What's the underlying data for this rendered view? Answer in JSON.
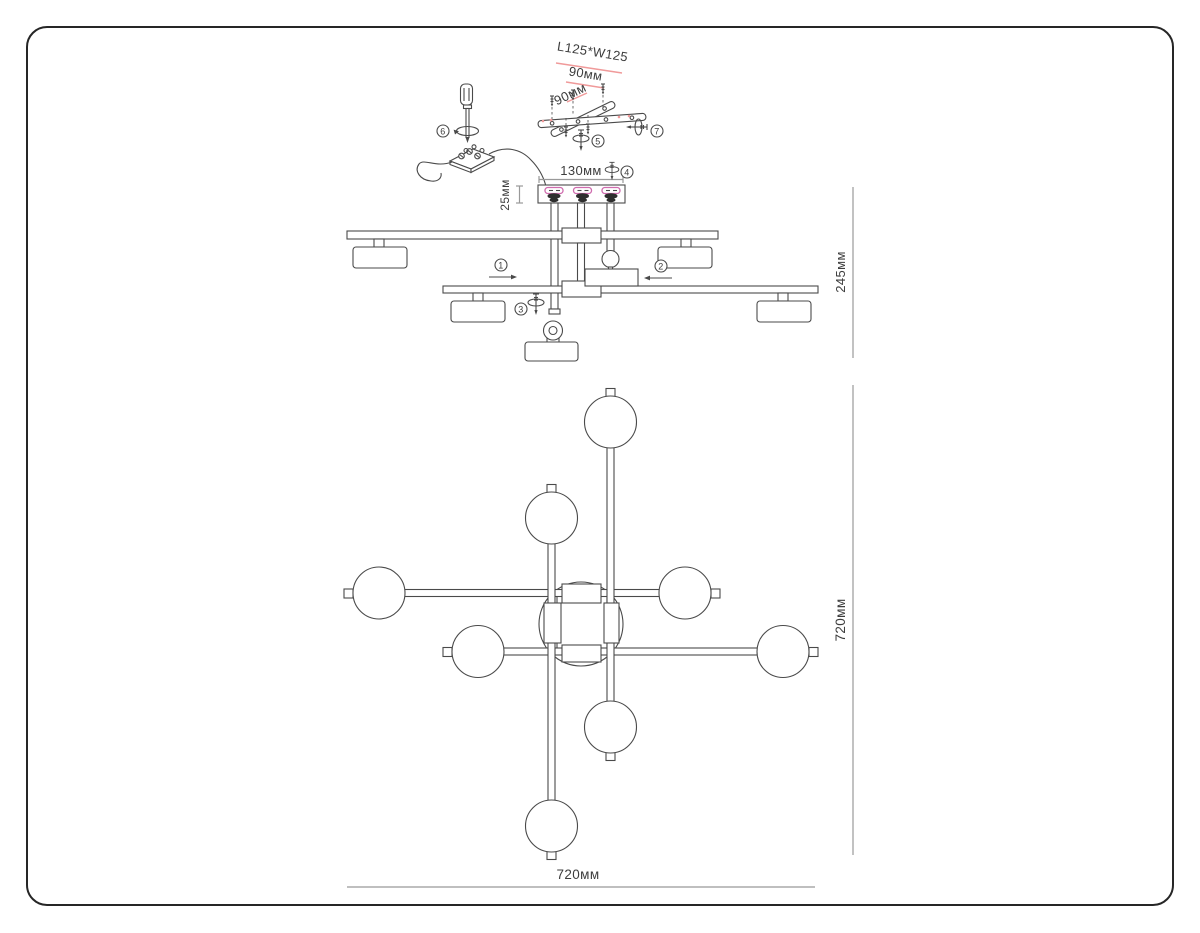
{
  "title": "Ceiling chandelier assembly instruction drawing",
  "colors": {
    "line": "#4a4a4a",
    "dim-line": "#999999",
    "text": "#3d3d3d",
    "accent-red": "#f09a9a",
    "accent-pink": "#cf6cae",
    "dark-fill": "#2e2e2e",
    "frame": "#262626",
    "background": "#ffffff"
  },
  "dimensions": {
    "bracket_size": "L125*W125",
    "bracket_spacing_a": "90мм",
    "bracket_spacing_b": "90мм",
    "canopy_width": "130мм",
    "canopy_height": "25мм",
    "fixture_height": "245мм",
    "plan_height": "720мм",
    "plan_width": "720мм"
  },
  "callouts": {
    "c1": "1",
    "c2": "2",
    "c3": "3",
    "c4": "4",
    "c5": "5",
    "c6": "6",
    "c7": "7"
  }
}
